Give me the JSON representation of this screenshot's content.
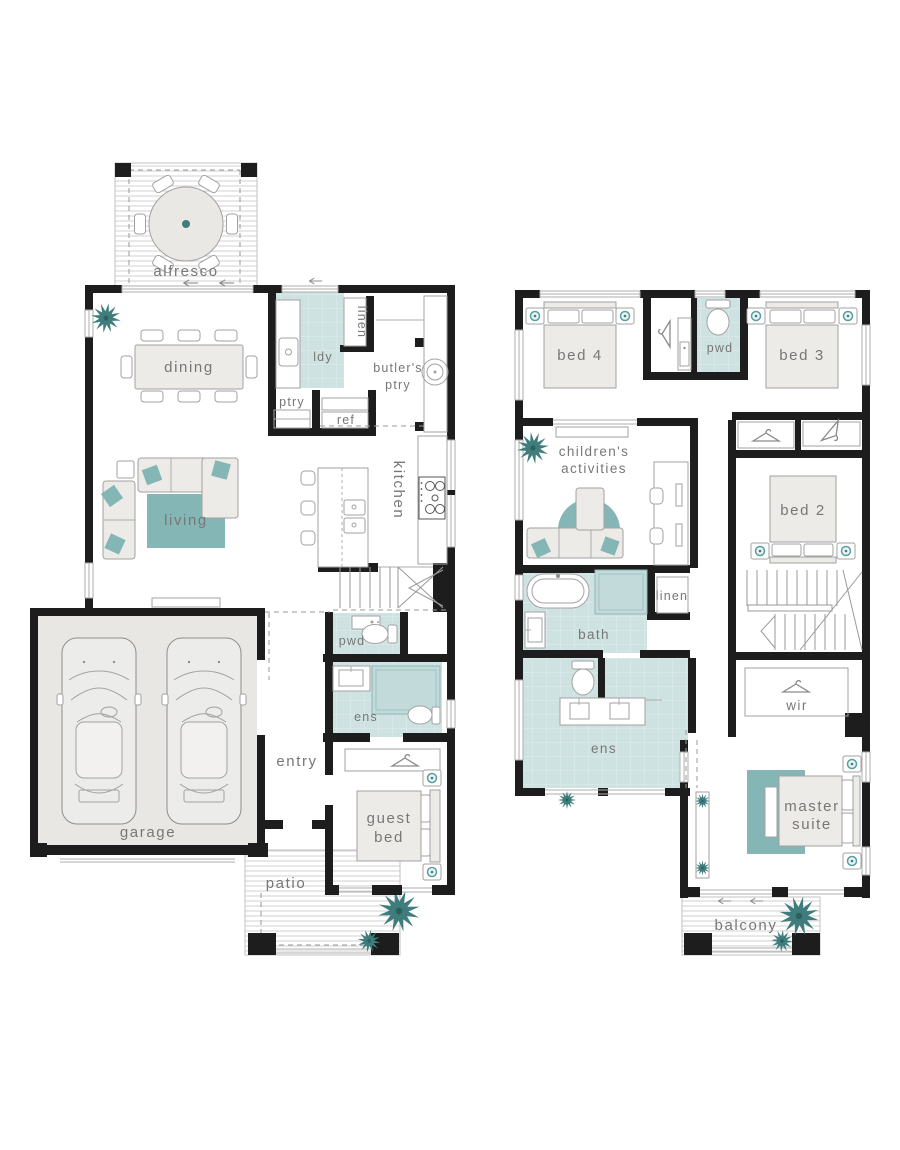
{
  "document": {
    "type": "two-storey house floor plan",
    "floors": [
      "ground floor",
      "first floor"
    ]
  },
  "palette": {
    "wall": "#1d1d1d",
    "wet_area_fill": "#cfe2e2",
    "tile_line": "#e0eded",
    "accent_teal": "#85b6b6",
    "accent_dark_teal": "#3f7d7d",
    "furniture_fill": "#edebe8",
    "furniture_stroke": "#a2a2a2",
    "garage_floor": "#e8e7e4",
    "label_color": "#777777",
    "deck_line": "#cccccc"
  },
  "ground_floor": {
    "labels": {
      "alfresco": "alfresco",
      "dining": "dining",
      "ldy": "ldy",
      "linen": "linen",
      "butlers_line1": "butler's",
      "butlers_line2": "ptry",
      "ptry": "ptry",
      "ref": "ref",
      "kitchen": "kitchen",
      "living": "living",
      "pwd": "pwd",
      "ens": "ens",
      "entry": "entry",
      "guest_line1": "guest",
      "guest_line2": "bed",
      "garage": "garage",
      "patio": "patio"
    }
  },
  "first_floor": {
    "labels": {
      "bed4": "bed 4",
      "pwd": "pwd",
      "bed3": "bed 3",
      "childrens_line1": "children's",
      "childrens_line2": "activities",
      "bed2": "bed 2",
      "bath": "bath",
      "linen": "linen",
      "ens": "ens",
      "wir": "wir",
      "master_line1": "master",
      "master_line2": "suite",
      "balcony": "balcony"
    }
  }
}
